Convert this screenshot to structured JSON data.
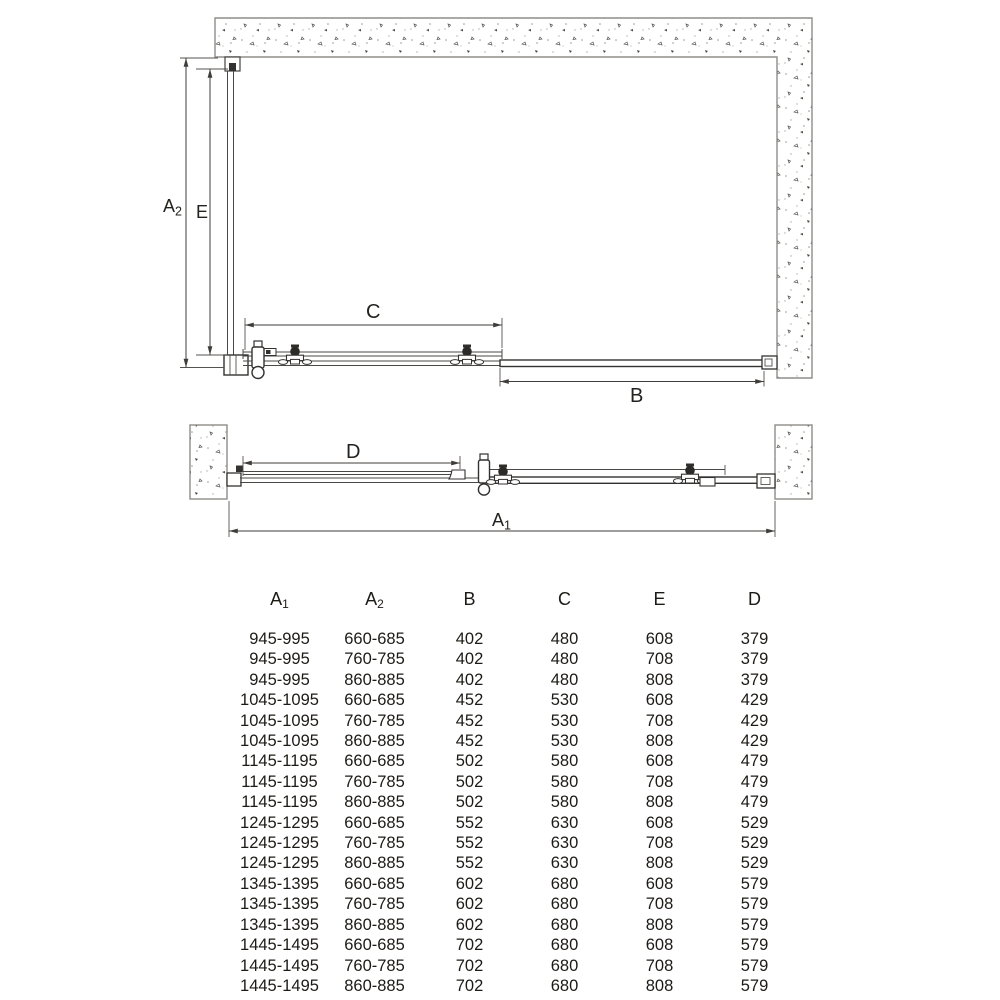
{
  "diagram_plan": {
    "labels": {
      "a2": {
        "main": "A",
        "sub": "2"
      },
      "e": {
        "main": "E",
        "sub": ""
      },
      "c": {
        "main": "C",
        "sub": ""
      },
      "b": {
        "main": "B",
        "sub": ""
      }
    }
  },
  "diagram_front": {
    "labels": {
      "d": {
        "main": "D",
        "sub": ""
      },
      "a1": {
        "main": "A",
        "sub": "1"
      }
    }
  },
  "table": {
    "columns": [
      {
        "main": "A",
        "sub": "1"
      },
      {
        "main": "A",
        "sub": "2"
      },
      {
        "main": "B",
        "sub": ""
      },
      {
        "main": "C",
        "sub": ""
      },
      {
        "main": "E",
        "sub": ""
      },
      {
        "main": "D",
        "sub": ""
      }
    ],
    "rows": [
      [
        "945-995",
        "660-685",
        "402",
        "480",
        "608",
        "379"
      ],
      [
        "945-995",
        "760-785",
        "402",
        "480",
        "708",
        "379"
      ],
      [
        "945-995",
        "860-885",
        "402",
        "480",
        "808",
        "379"
      ],
      [
        "1045-1095",
        "660-685",
        "452",
        "530",
        "608",
        "429"
      ],
      [
        "1045-1095",
        "760-785",
        "452",
        "530",
        "708",
        "429"
      ],
      [
        "1045-1095",
        "860-885",
        "452",
        "530",
        "808",
        "429"
      ],
      [
        "1145-1195",
        "660-685",
        "502",
        "580",
        "608",
        "479"
      ],
      [
        "1145-1195",
        "760-785",
        "502",
        "580",
        "708",
        "479"
      ],
      [
        "1145-1195",
        "860-885",
        "502",
        "580",
        "808",
        "479"
      ],
      [
        "1245-1295",
        "660-685",
        "552",
        "630",
        "608",
        "529"
      ],
      [
        "1245-1295",
        "760-785",
        "552",
        "630",
        "708",
        "529"
      ],
      [
        "1245-1295",
        "860-885",
        "552",
        "630",
        "808",
        "529"
      ],
      [
        "1345-1395",
        "660-685",
        "602",
        "680",
        "608",
        "579"
      ],
      [
        "1345-1395",
        "760-785",
        "602",
        "680",
        "708",
        "579"
      ],
      [
        "1345-1395",
        "860-885",
        "602",
        "680",
        "808",
        "579"
      ],
      [
        "1445-1495",
        "660-685",
        "702",
        "680",
        "608",
        "579"
      ],
      [
        "1445-1495",
        "760-785",
        "702",
        "680",
        "708",
        "579"
      ],
      [
        "1445-1495",
        "860-885",
        "702",
        "680",
        "808",
        "579"
      ]
    ]
  },
  "colors": {
    "line": "#3f3d39",
    "wall_stroke": "#8f8d89",
    "text": "#1d1b16",
    "background": "#ffffff"
  }
}
